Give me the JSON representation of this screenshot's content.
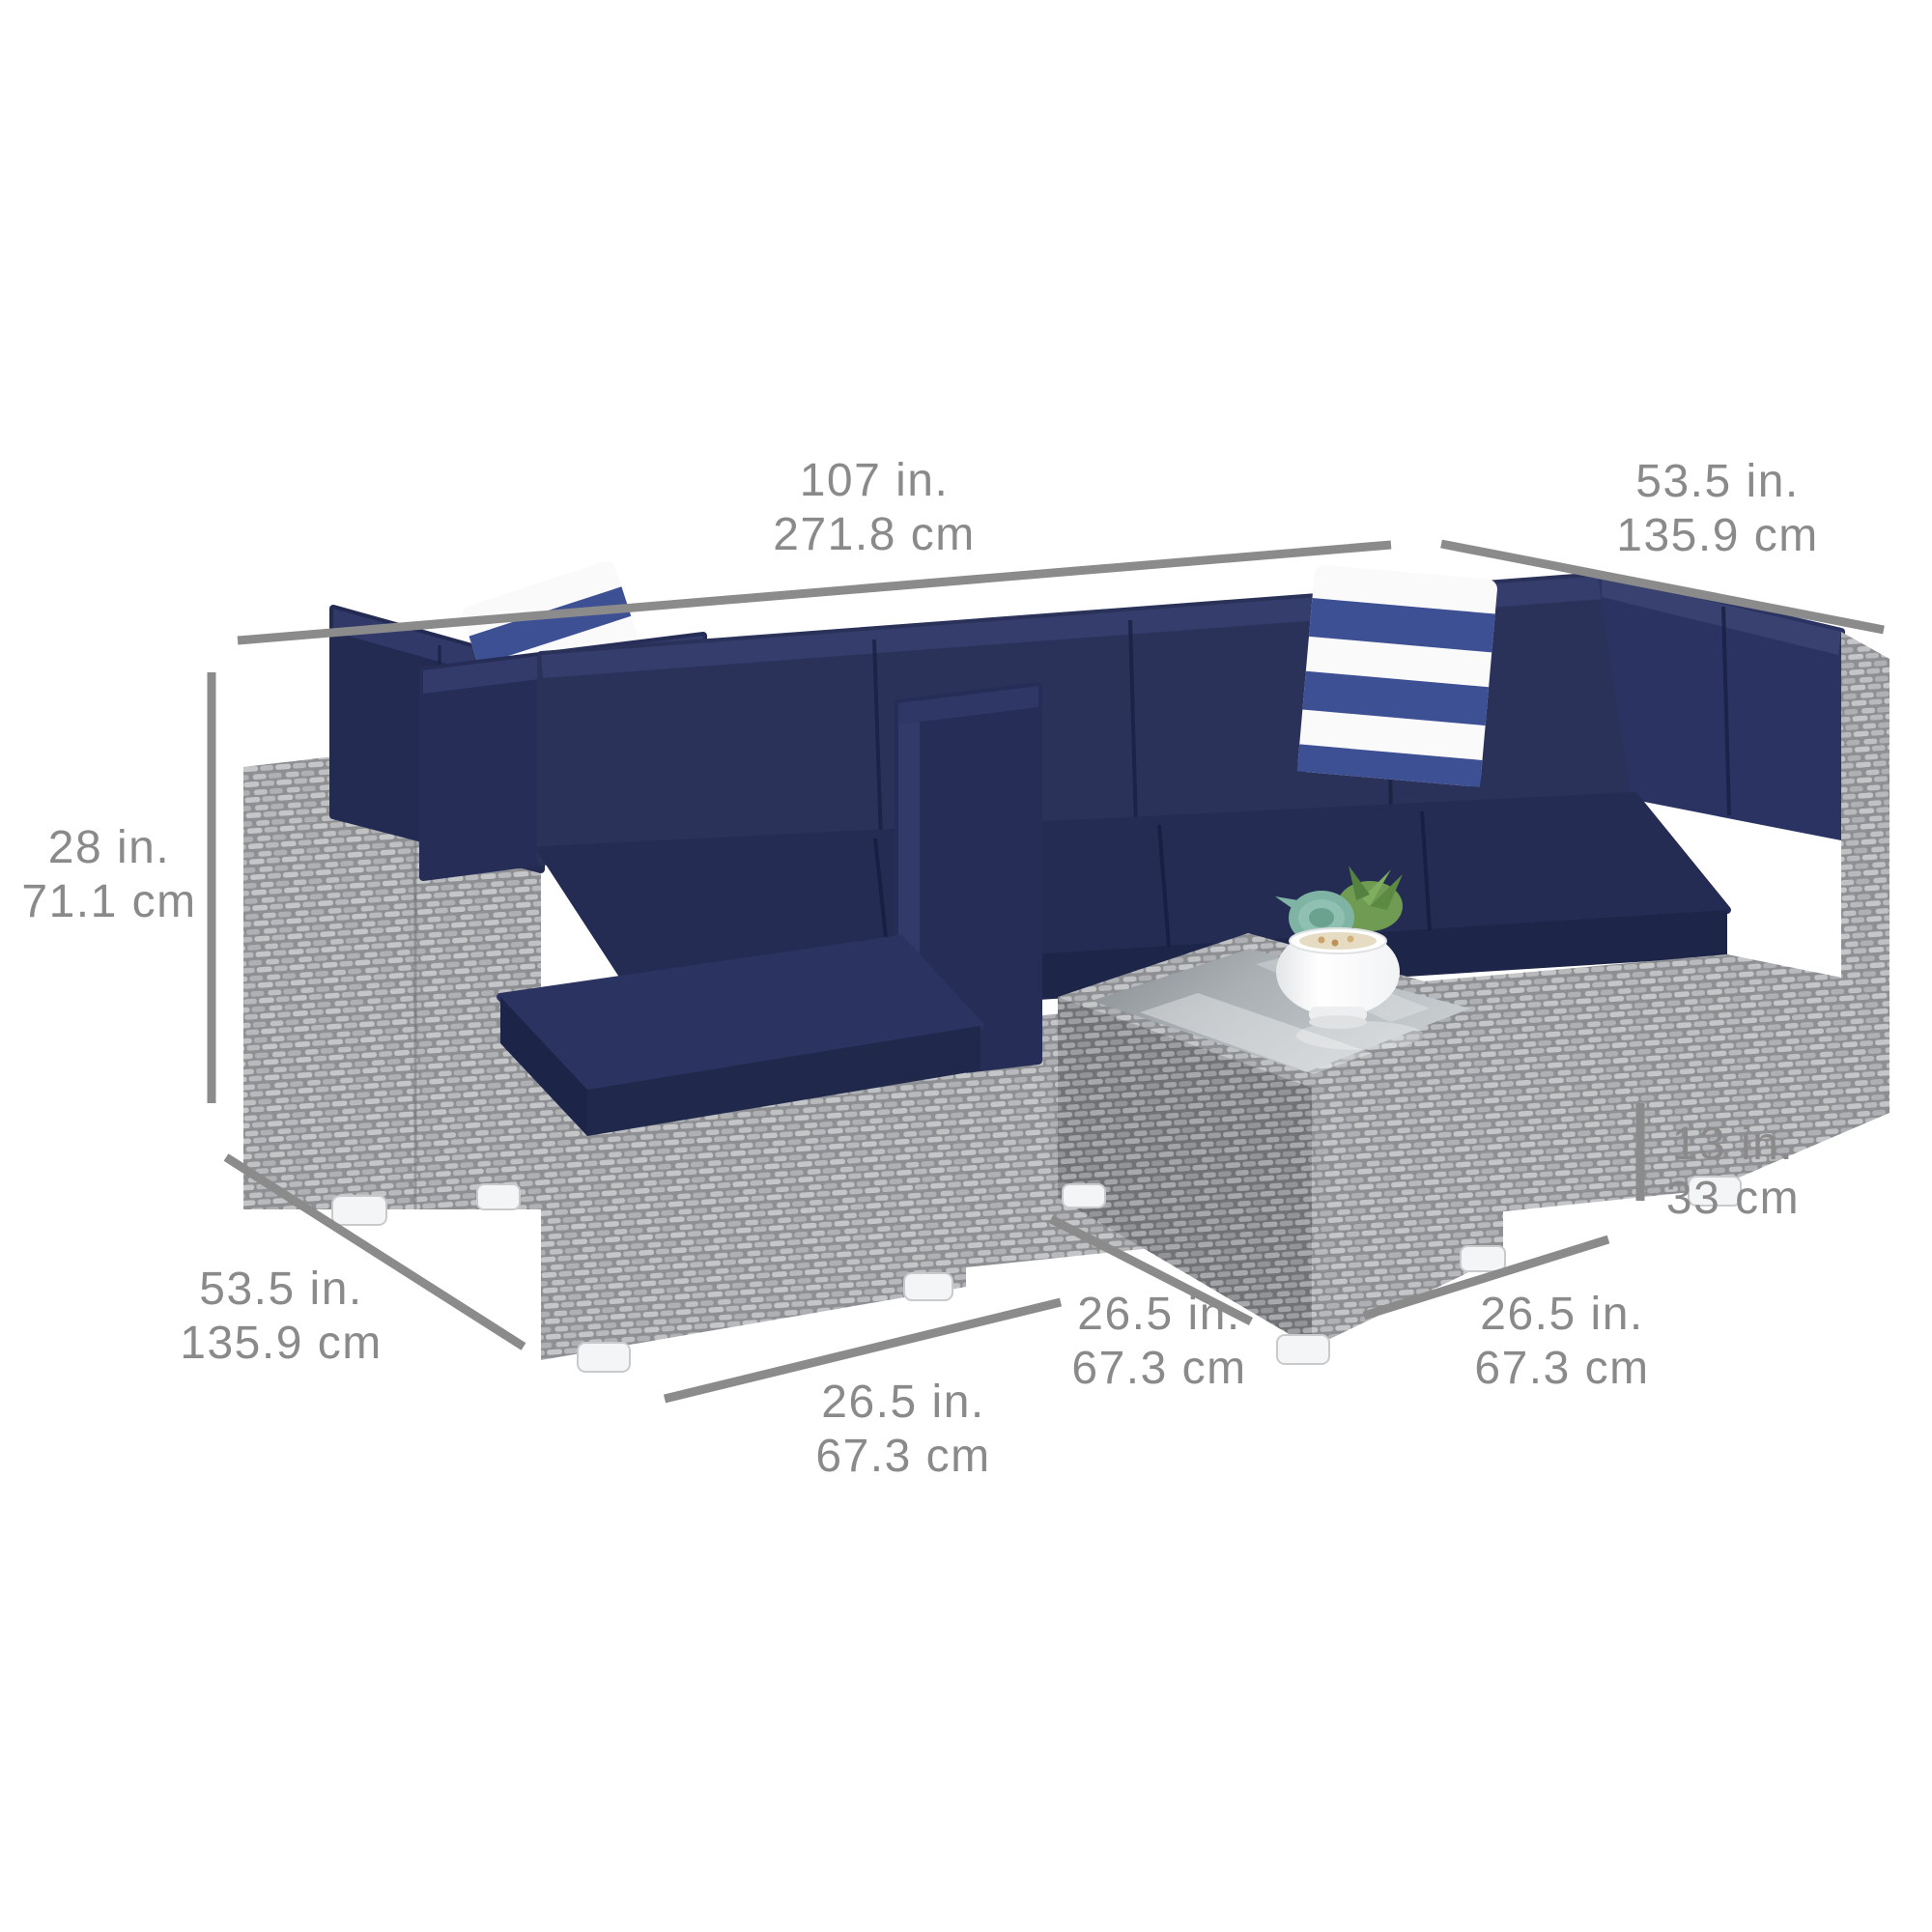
{
  "title": "Outdoor wicker sectional sofa set dimension diagram",
  "colors": {
    "background": "#ffffff",
    "dimension_line": "#8b8b8b",
    "dimension_text": "#8a8a8a",
    "cushion_navy": "#262e57",
    "pillow_stripe_blue": "#3e5094",
    "wicker_gray": "#aaacaf",
    "glass_gray": "#a7adb1",
    "pot_white": "#fbfbfb",
    "succulent_teal": "#7fb3a4",
    "succulent_green": "#6f9c52"
  },
  "labels": {
    "sofa_width": {
      "in": "107 in.",
      "cm": "271.8 cm"
    },
    "right_depth": {
      "in": "53.5 in.",
      "cm": "135.9 cm"
    },
    "sofa_height": {
      "in": "28 in.",
      "cm": "71.1 cm"
    },
    "left_depth": {
      "in": "53.5 in.",
      "cm": "135.9 cm"
    },
    "front_section_width": {
      "in": "26.5 in.",
      "cm": "67.3 cm"
    },
    "table_depth": {
      "in": "26.5 in.",
      "cm": "67.3 cm"
    },
    "table_width": {
      "in": "26.5 in.",
      "cm": "67.3 cm"
    },
    "table_height": {
      "in": "13 in.",
      "cm": "33 cm"
    }
  }
}
